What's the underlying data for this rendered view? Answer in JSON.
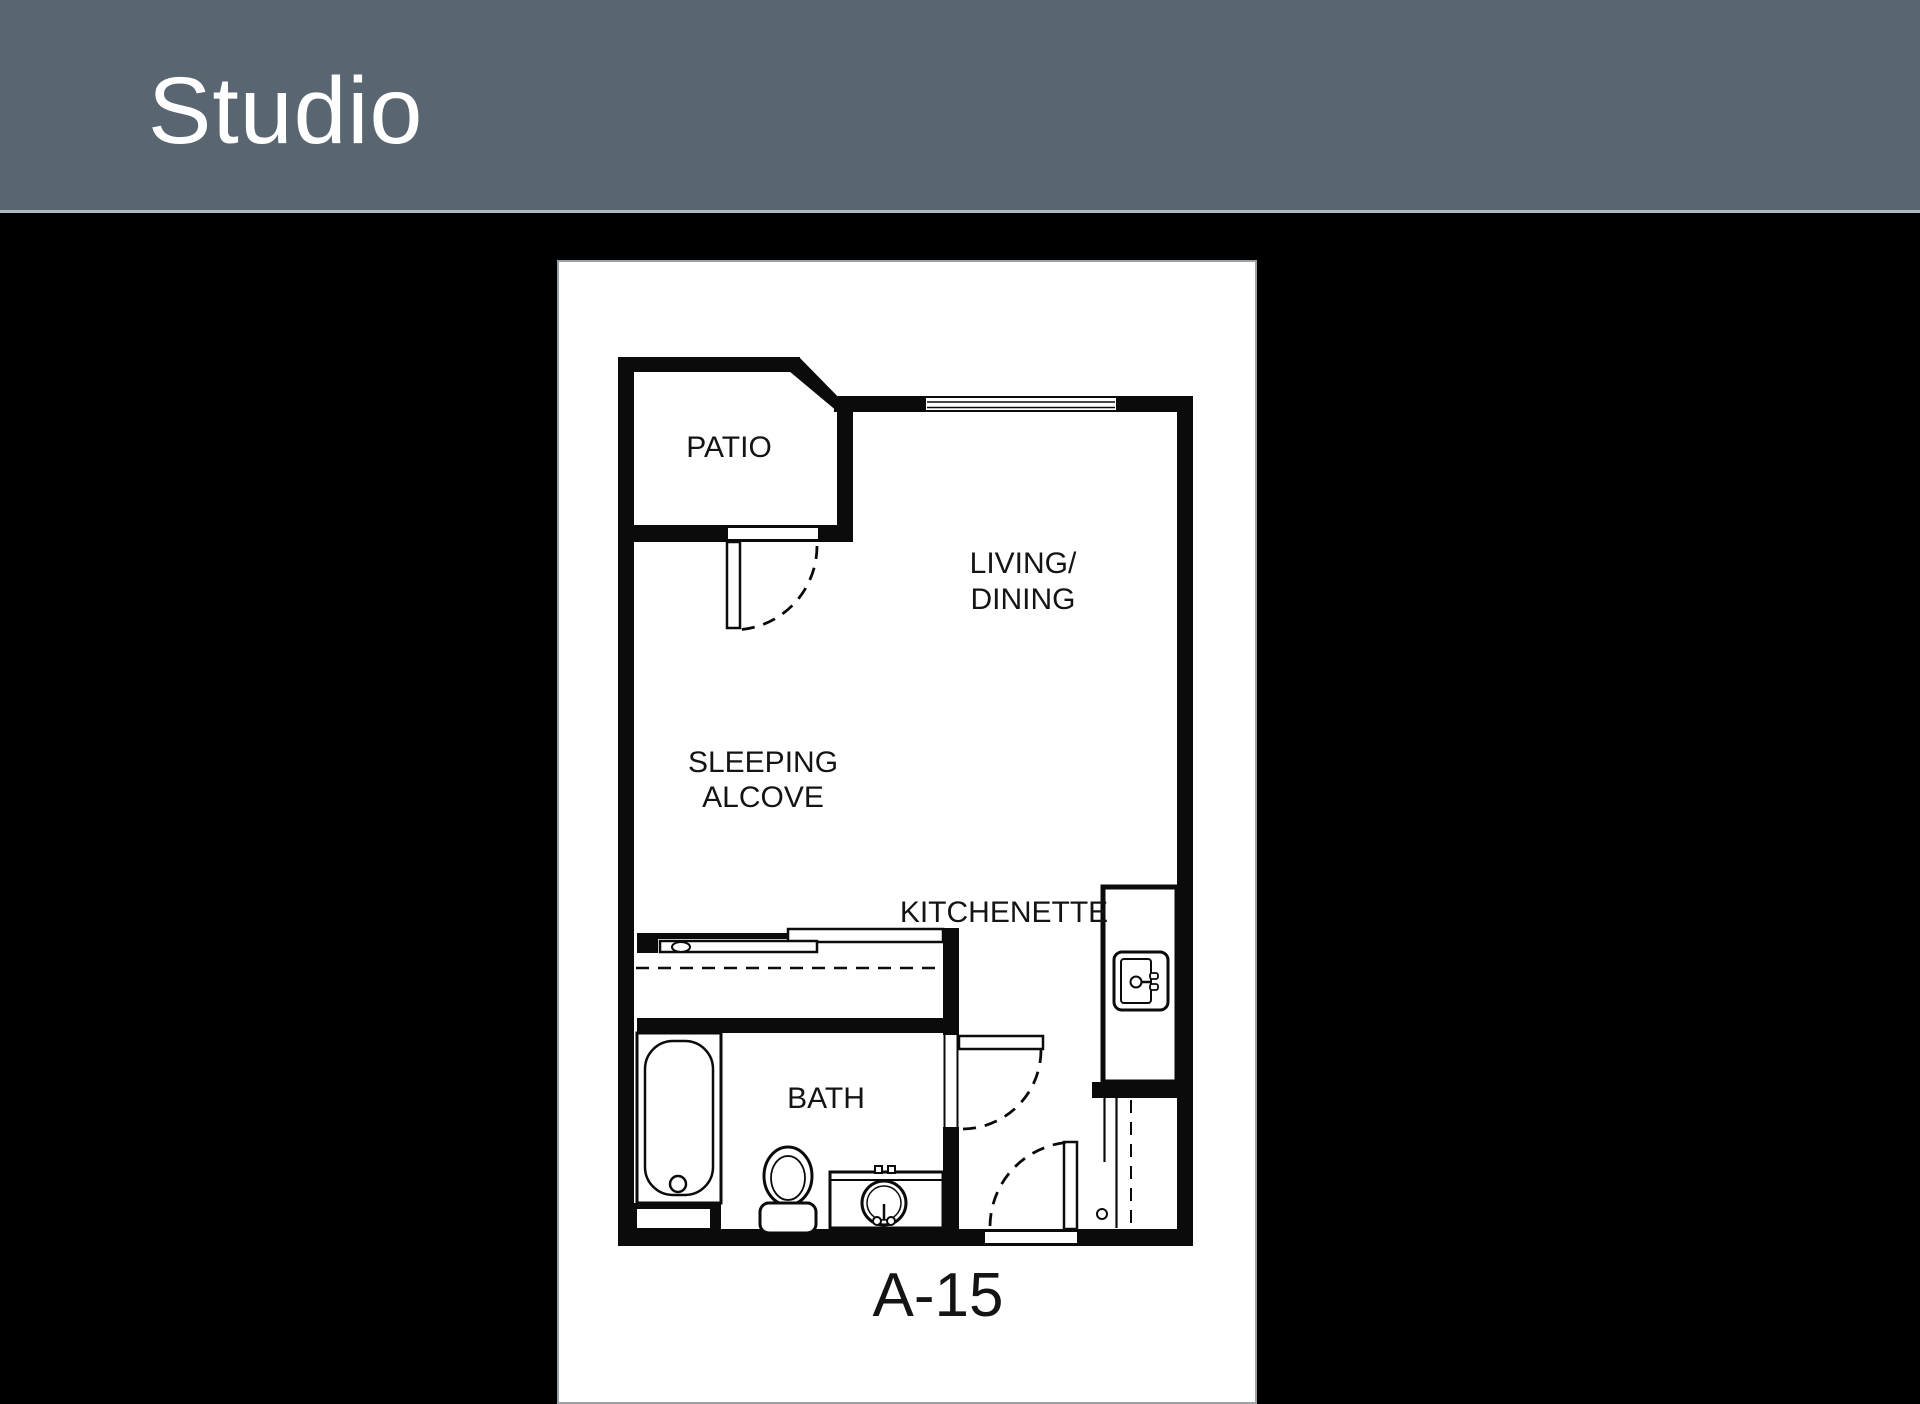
{
  "header": {
    "title": "Studio",
    "background_color": "#596672",
    "border_color": "#aeb9c0",
    "text_color": "#ffffff"
  },
  "page": {
    "background_color": "#000000",
    "panel_background_color": "#ffffff",
    "line_color": "#0b0b0b"
  },
  "floor_plan": {
    "unit_label": "A-15",
    "labels": {
      "patio": "PATIO",
      "living_line1": "LIVING/",
      "living_line2": "DINING",
      "sleeping_line1": "SLEEPING",
      "sleeping_line2": "ALCOVE",
      "kitchenette": "KITCHENETTE",
      "bath": "BATH"
    },
    "icons": [
      "window-icon",
      "patio-door-icon",
      "closet-sliding-doors-icon",
      "bath-door-icon",
      "entry-door-icon",
      "bathtub-icon",
      "toilet-icon",
      "bathroom-sink-icon",
      "kitchen-sink-icon",
      "hall-closet-icon"
    ]
  }
}
